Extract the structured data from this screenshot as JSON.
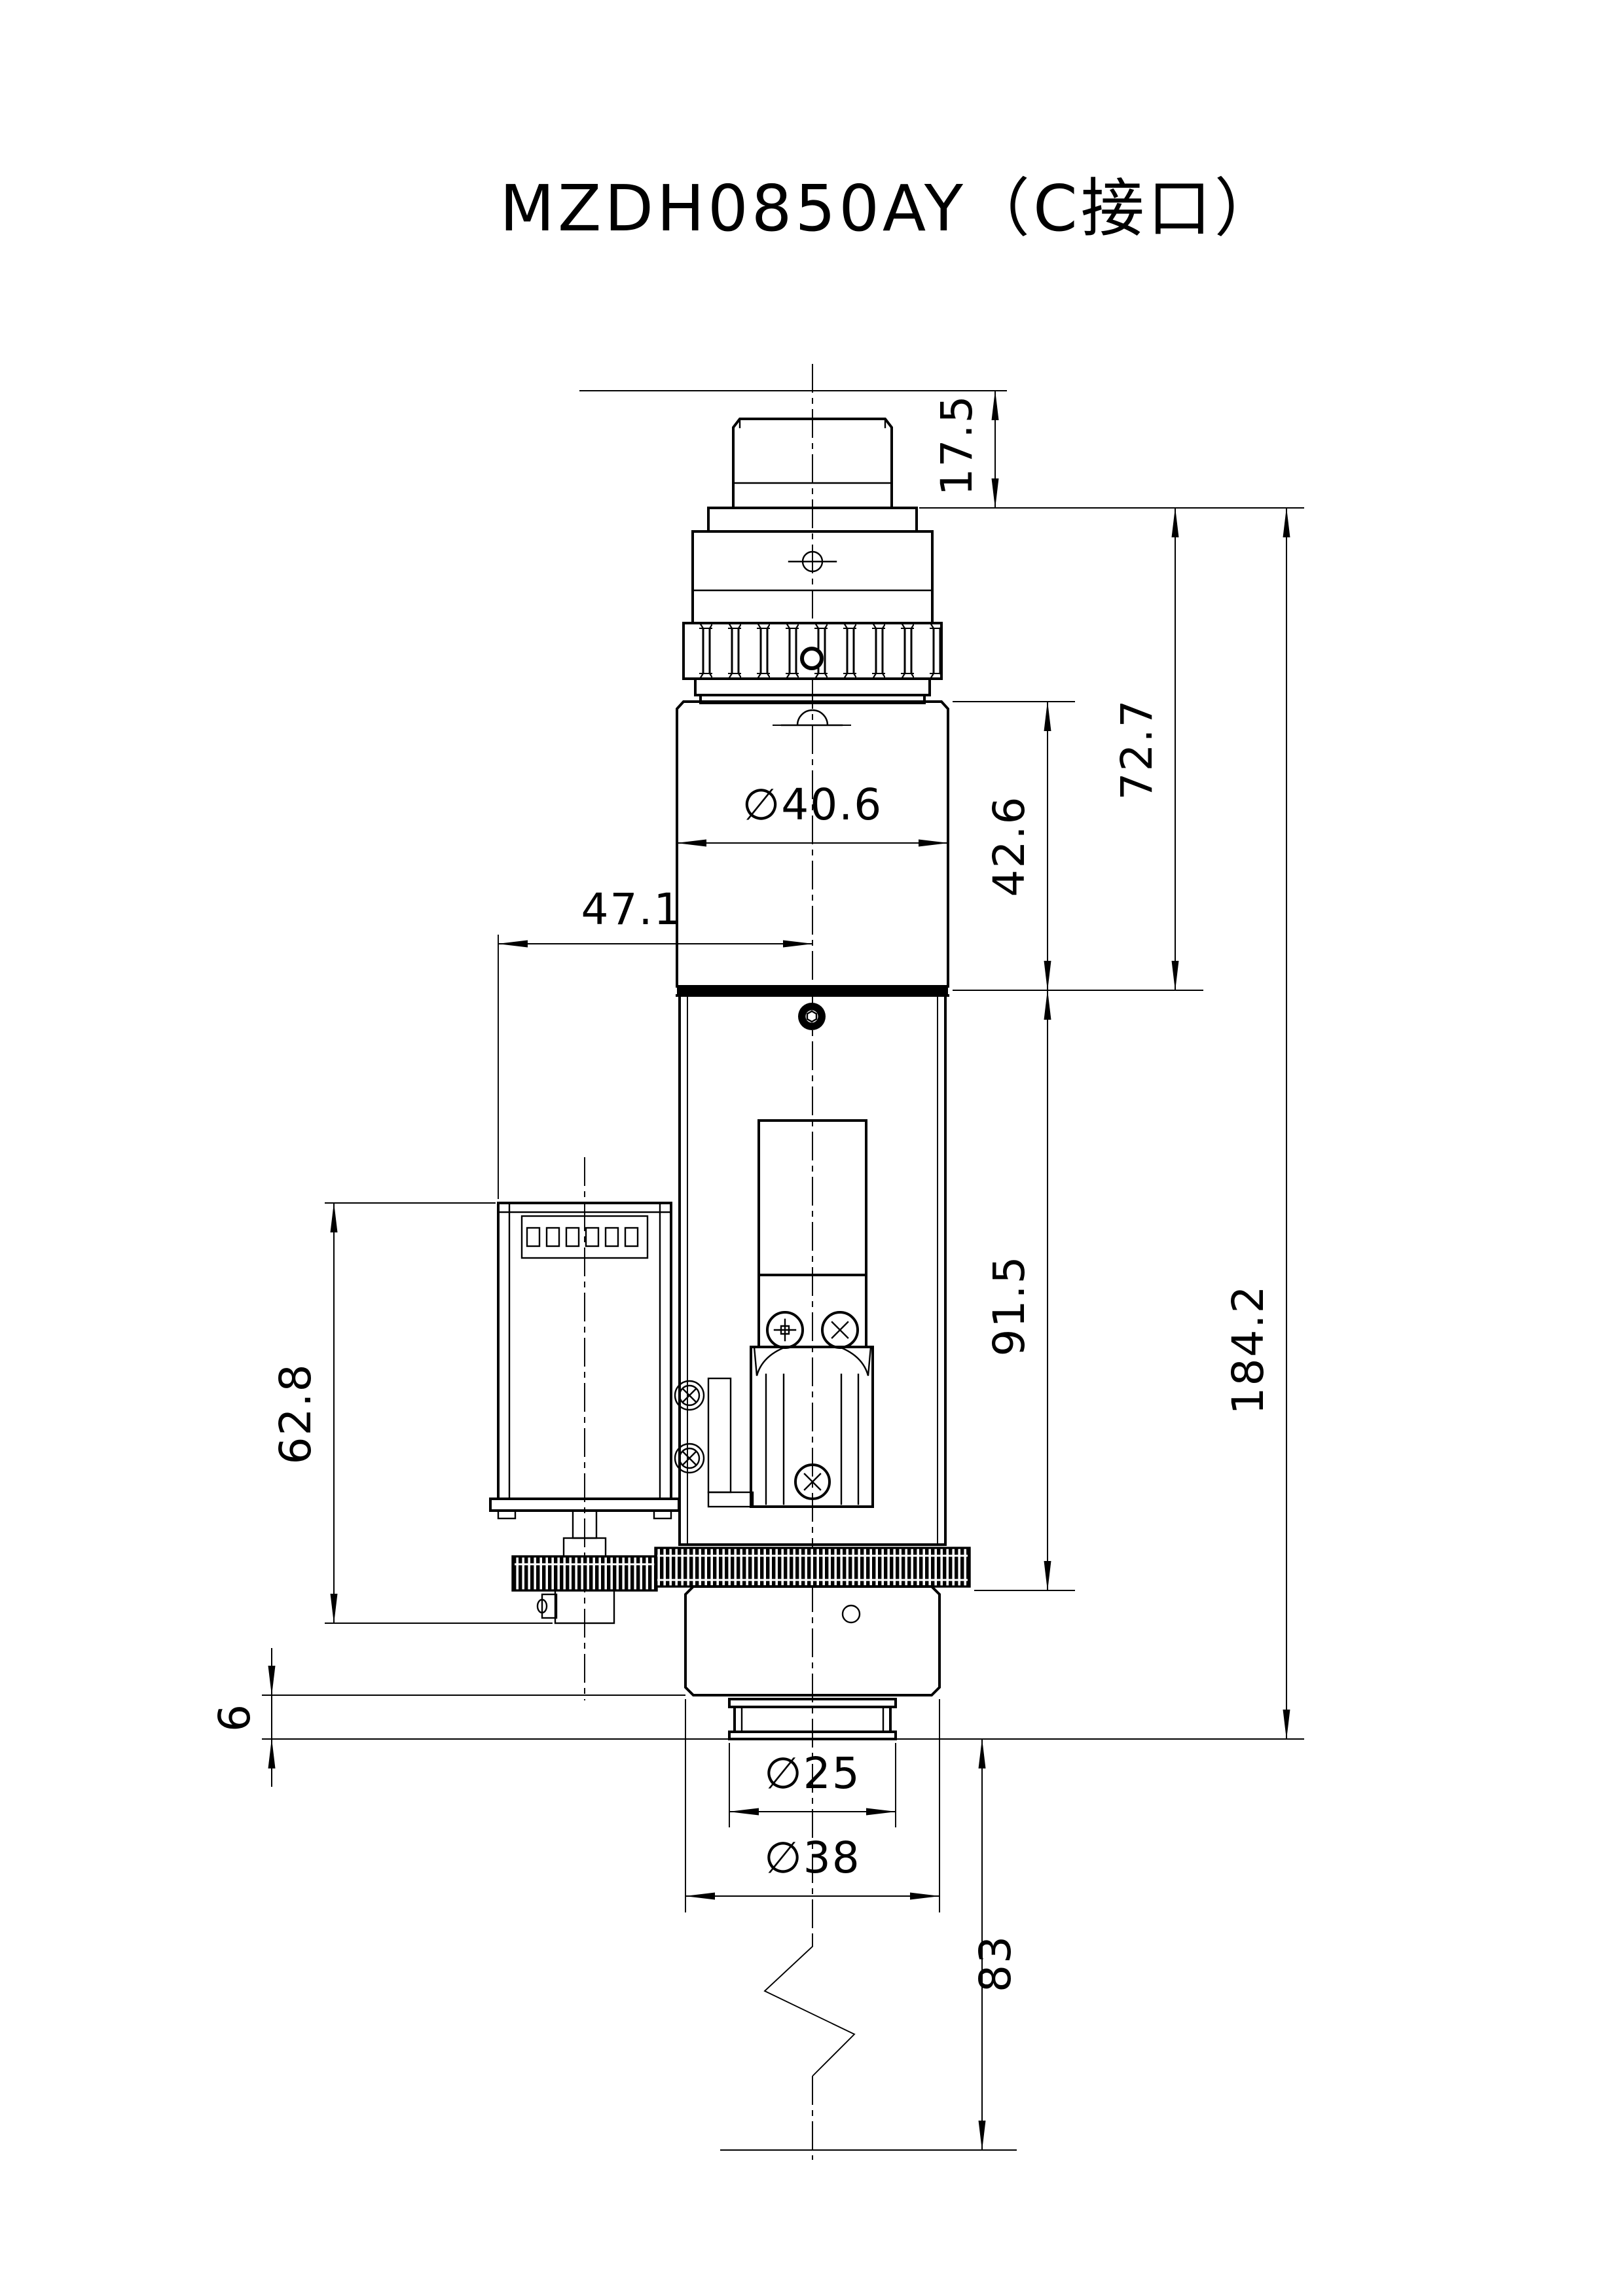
{
  "title": "MZDH0850AY（C接口）",
  "drawing_type": "dimensioned engineering drawing of motorized zoom lens, front view",
  "colors": {
    "line": "#000000",
    "background": "#ffffff"
  },
  "dims": {
    "flange_focal": {
      "label": "17.5"
    },
    "upper_length": {
      "label": "72.7"
    },
    "barrel_dia": {
      "label": "∅40.6"
    },
    "barrel_length": {
      "label": "42.6"
    },
    "motor_offset": {
      "label": "47.1"
    },
    "total_length": {
      "label": "184.2"
    },
    "lower_length": {
      "label": "91.5"
    },
    "motor_length": {
      "label": "62.8"
    },
    "tip_step": {
      "label": "6"
    },
    "tip_dia_inner": {
      "label": "∅25"
    },
    "tip_dia_outer": {
      "label": "∅38"
    },
    "working_distance": {
      "label": "83"
    }
  }
}
